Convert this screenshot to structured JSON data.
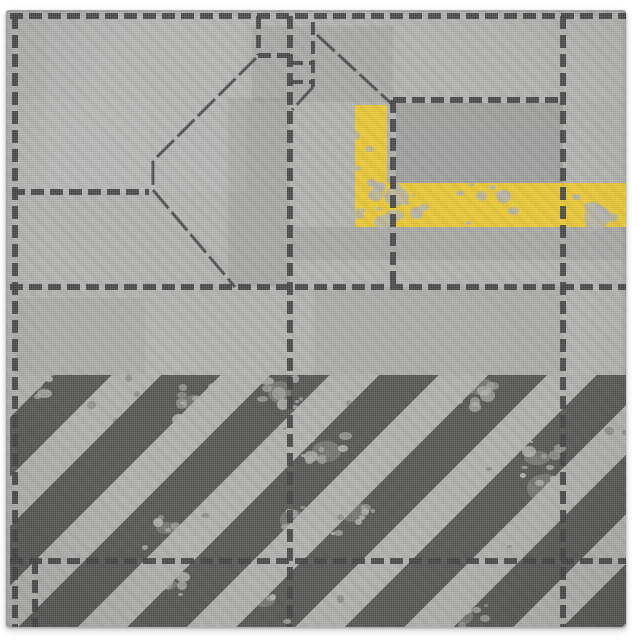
{
  "product": {
    "type": "fabric-swatch-photo",
    "pattern_name": "distressed sci-fi hull panels with caution stripes",
    "background_color": "#ffffff"
  },
  "swatch": {
    "left": 6,
    "top": 10,
    "width": 620,
    "height": 617,
    "base_color": "#b2b2b0"
  },
  "colors": {
    "panel_dash": "#3f3f3f",
    "seam": "#4f4f4f",
    "stripe_dark": "#545452",
    "stripe_light": "#b0b0ae",
    "caution_yellow": "#eac832",
    "distress_gray": "#b1b1af",
    "grime_dark": "#55554f"
  },
  "dashes": {
    "thickness": 6,
    "dash": 13,
    "gap": 6
  },
  "panel_lines": {
    "horizontal": [
      {
        "y": 6,
        "x1": 4,
        "x2": 620
      },
      {
        "y": 90,
        "x1": 387,
        "x2": 560
      },
      {
        "y": 182,
        "x1": 6,
        "x2": 143
      },
      {
        "y": 277,
        "x1": 4,
        "x2": 620
      },
      {
        "y": 551,
        "x1": 4,
        "x2": 620
      },
      {
        "y": 45,
        "x1": 252,
        "x2": 284,
        "thickness": 5
      },
      {
        "y": 53,
        "x1": 284,
        "x2": 307,
        "thickness": 4
      },
      {
        "y": 72,
        "x1": 284,
        "x2": 307,
        "thickness": 4
      }
    ],
    "vertical": [
      {
        "x": 9,
        "y1": 6,
        "y2": 617
      },
      {
        "x": 284,
        "y1": 6,
        "y2": 617
      },
      {
        "x": 557,
        "y1": 6,
        "y2": 617
      },
      {
        "x": 387,
        "y1": 90,
        "y2": 277
      },
      {
        "x": 29,
        "y1": 551,
        "y2": 617
      },
      {
        "x": 252,
        "y1": 6,
        "y2": 45,
        "thickness": 5
      },
      {
        "x": 307,
        "y1": 12,
        "y2": 77,
        "thickness": 4
      }
    ]
  },
  "seams": [
    [
      250,
      48,
      147,
      151
    ],
    [
      147,
      151,
      147,
      180
    ],
    [
      147,
      180,
      229,
      277
    ],
    [
      311,
      25,
      387,
      95
    ],
    [
      307,
      77,
      286,
      100
    ]
  ],
  "yellow_marking": {
    "bar": {
      "x": 349,
      "y": 95,
      "w": 32,
      "h": 122
    },
    "band": {
      "x": 349,
      "y": 173,
      "w": 271,
      "h": 44
    }
  },
  "hazard_field": {
    "x": 4,
    "y": 365,
    "w": 616,
    "h": 252,
    "angle_deg": 45,
    "dark_width_px": 42,
    "light_width_px": 35,
    "phase_px": 30
  },
  "tone_patches": [
    {
      "x": 390,
      "y": 93,
      "w": 167,
      "h": 80,
      "color": "rgba(0,0,0,0.10)"
    },
    {
      "x": 246,
      "y": 16,
      "w": 141,
      "h": 76,
      "color": "rgba(0,0,0,0.05)"
    },
    {
      "x": 222,
      "y": 88,
      "w": 62,
      "h": 189,
      "color": "rgba(0,0,0,0.06)"
    },
    {
      "x": 284,
      "y": 217,
      "w": 336,
      "h": 33,
      "color": "rgba(0,0,0,0.05)"
    },
    {
      "x": 9,
      "y": 288,
      "w": 130,
      "h": 170,
      "color": "rgba(0,0,0,0.04)"
    },
    {
      "x": 40,
      "y": 6,
      "w": 200,
      "h": 176,
      "color": "rgba(255,255,255,0.05)"
    },
    {
      "x": 309,
      "y": 277,
      "w": 248,
      "h": 88,
      "color": "rgba(0,0,0,0.04)"
    },
    {
      "x": 557,
      "y": 6,
      "w": 63,
      "h": 84,
      "color": "rgba(255,255,255,0.04)"
    },
    {
      "x": 9,
      "y": 90,
      "w": 135,
      "h": 92,
      "color": "rgba(255,255,255,0.04)"
    }
  ]
}
